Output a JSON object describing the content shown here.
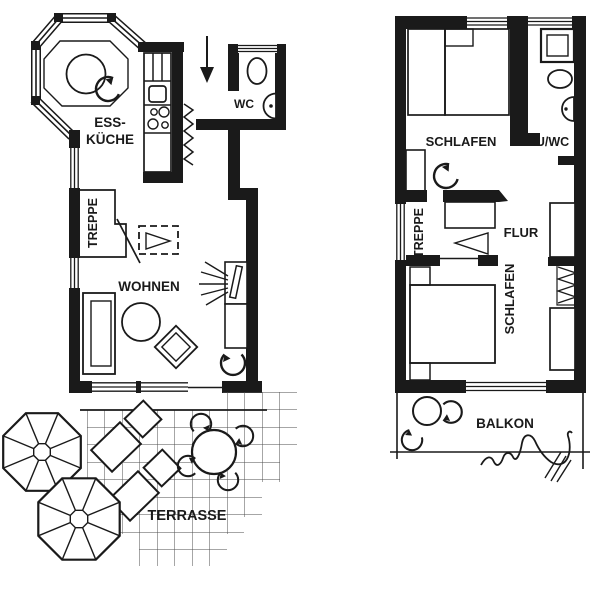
{
  "colors": {
    "ink": "#1a1a1a",
    "grid_line": "#4d4d4d",
    "background": "#ffffff"
  },
  "ground": {
    "labels": {
      "kitchen_line1": "ESS-",
      "kitchen_line2": "KÜCHE",
      "wc": "WC",
      "stairs": "TREPPE",
      "living": "WOHNEN",
      "terrace": "TERRASSE"
    }
  },
  "upper": {
    "labels": {
      "bedroom_top": "SCHLAFEN",
      "bath": "DU/WC",
      "stairs": "TREPPE",
      "hall": "FLUR",
      "bedroom_bottom": "SCHLAFEN",
      "balcony": "BALKON"
    }
  }
}
